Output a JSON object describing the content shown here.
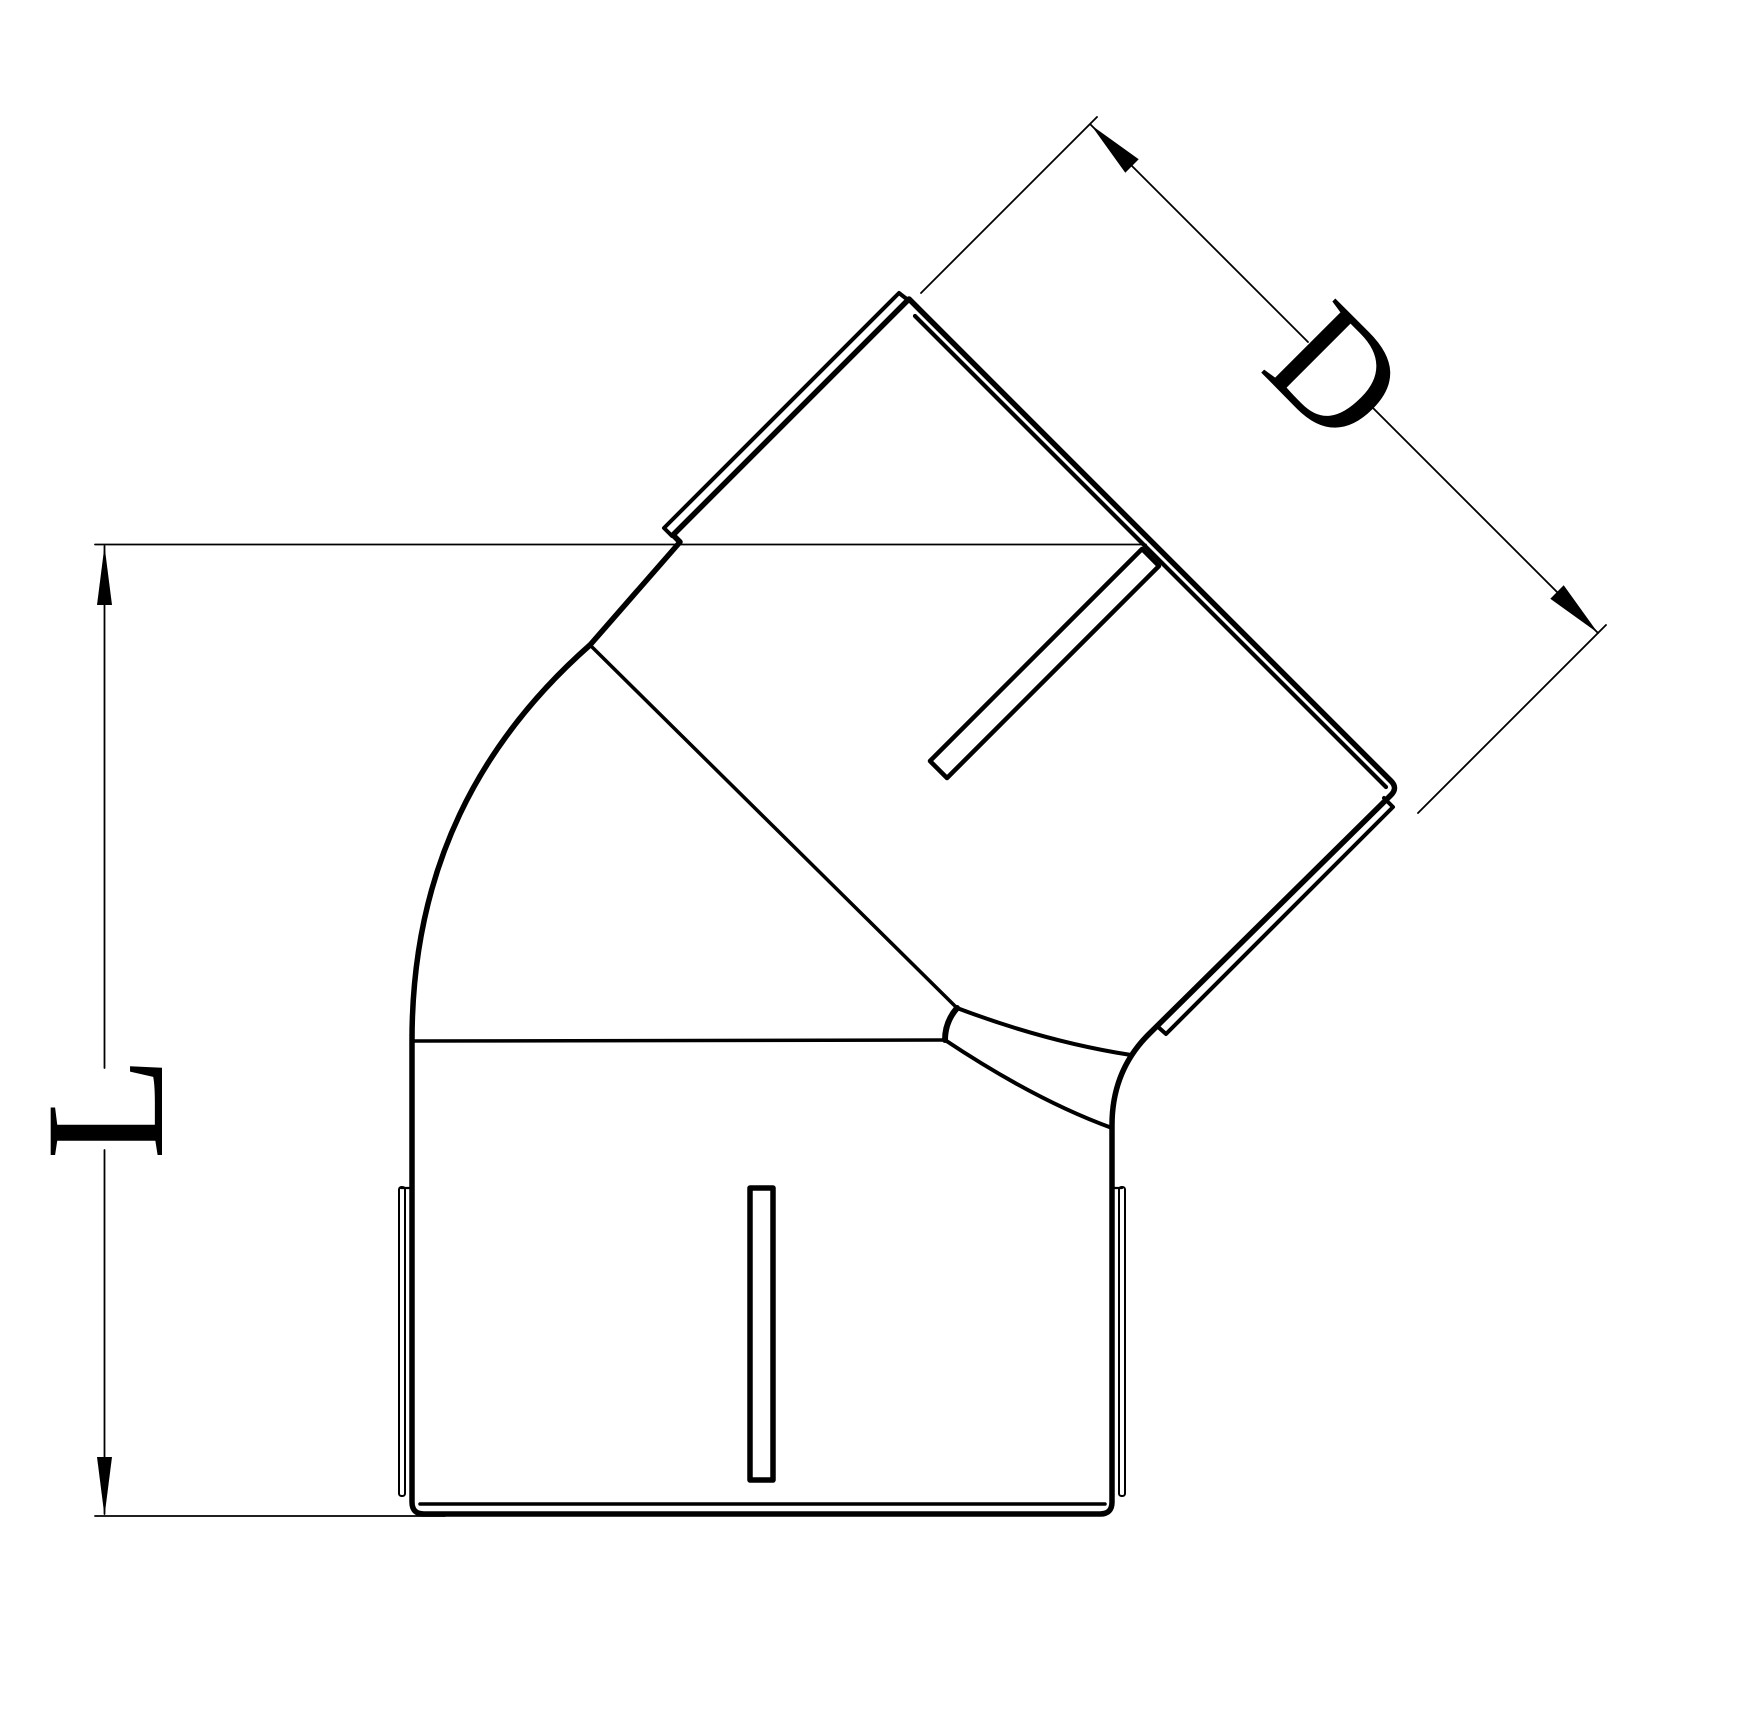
{
  "canvas": {
    "width": 1747,
    "height": 1709,
    "background": "#ffffff"
  },
  "colors": {
    "line": "#000000"
  },
  "drawing": {
    "labels": {
      "diameter": "D",
      "length": "L"
    }
  }
}
